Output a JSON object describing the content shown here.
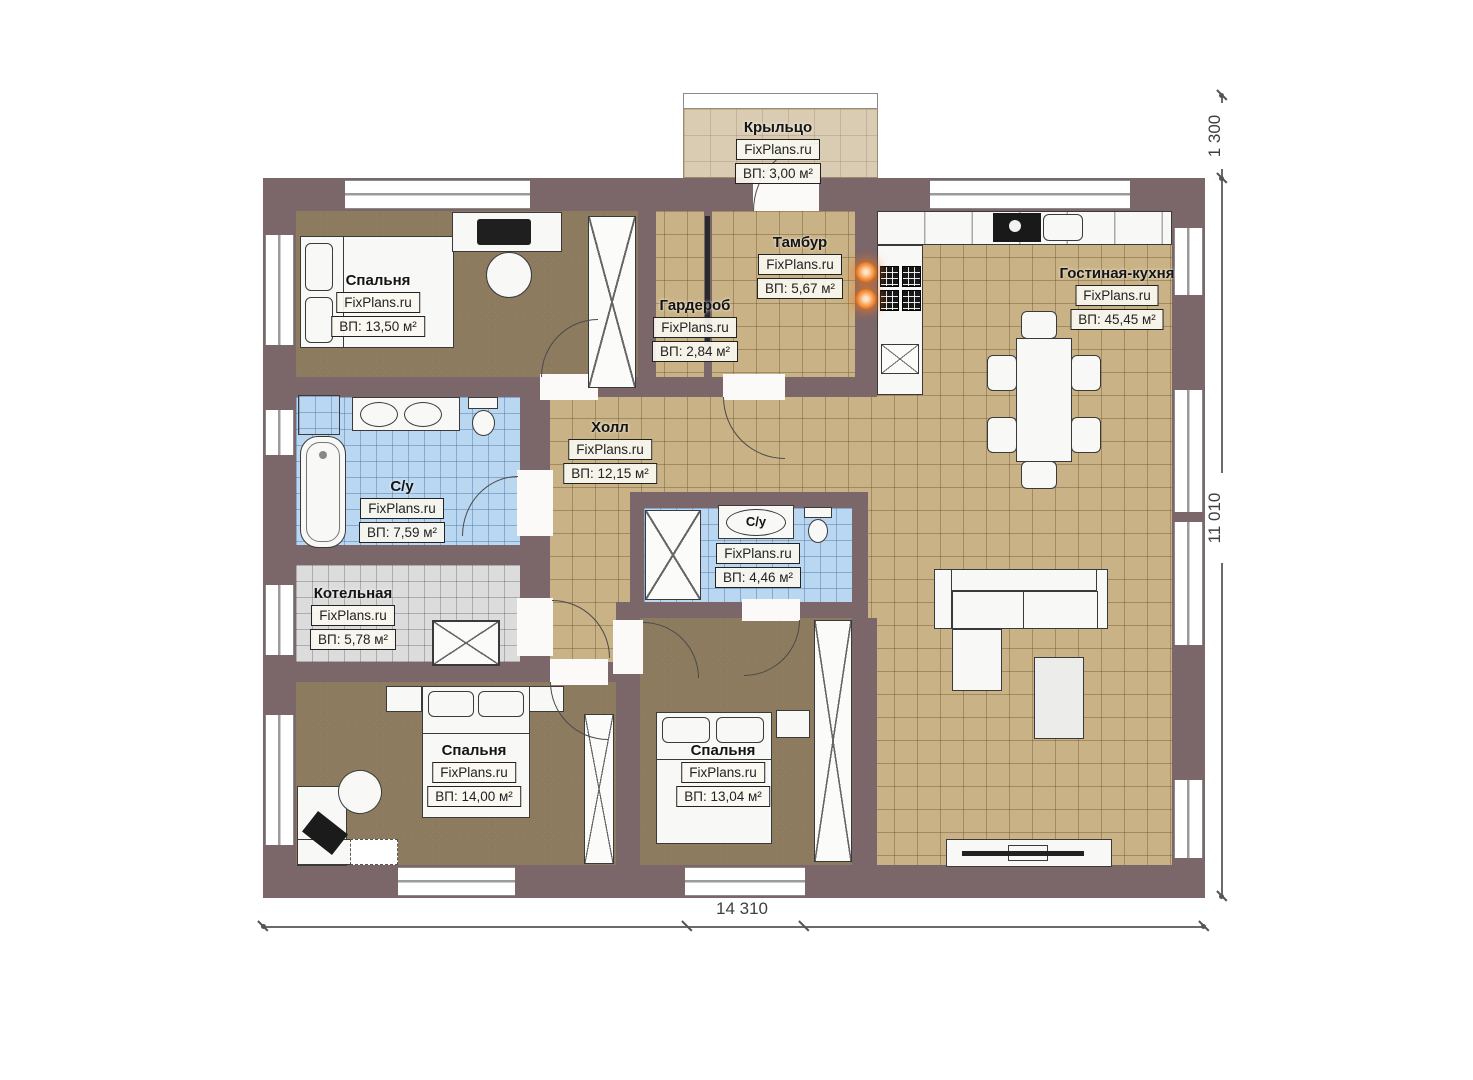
{
  "brand": "FixPlans.ru",
  "rooms": {
    "porch": {
      "name": "Крыльцо",
      "area": "ВП: 3,00 м²"
    },
    "tambour": {
      "name": "Тамбур",
      "area": "ВП: 5,67 м²"
    },
    "wardrobe": {
      "name": "Гардероб",
      "area": "ВП: 2,84 м²"
    },
    "living_kitchen": {
      "name": "Гостиная-кухня",
      "area": "ВП: 45,45 м²"
    },
    "bedroom_top": {
      "name": "Спальня",
      "area": "ВП: 13,50 м²"
    },
    "hall": {
      "name": "Холл",
      "area": "ВП: 12,15 м²"
    },
    "bathroom_main": {
      "name": "С/у",
      "area": "ВП: 7,59 м²"
    },
    "bathroom_small": {
      "name": "С/у",
      "area": "ВП: 4,46 м²"
    },
    "boiler": {
      "name": "Котельная",
      "area": "ВП: 5,78 м²"
    },
    "bedroom_left": {
      "name": "Спальня",
      "area": "ВП: 14,00 м²"
    },
    "bedroom_mid": {
      "name": "Спальня",
      "area": "ВП: 13,04 м²"
    }
  },
  "dimensions": {
    "total_width": "14 310",
    "total_height": "11 010",
    "porch_depth": "1 300"
  },
  "colors": {
    "wall": "#7b666a",
    "floor_tile": "#c9b285",
    "floor_wood": "#8d7b5f",
    "floor_bath": "#bad7f2",
    "floor_boiler": "#dcdcdc",
    "porch": "#d9ccb3",
    "accent_outlet": "#ef7b1e"
  }
}
